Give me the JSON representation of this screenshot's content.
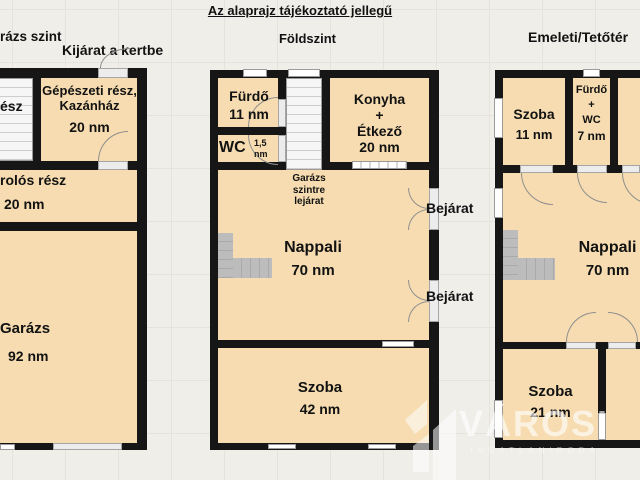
{
  "title": "Az alaprajz tájékoztató jellegű",
  "floors": {
    "garage_level": {
      "header": "rázs szint",
      "garden_exit_label": "Kijárat a kertbe",
      "stair_room_label": "ész",
      "mechanical_room": {
        "name": "Gépészeti rész, Kazánház",
        "area": "20 nm"
      },
      "storage_room": {
        "name": "rolós rész",
        "area": "20 nm"
      },
      "garage_room": {
        "name": "Garázs",
        "area": "92 nm"
      }
    },
    "ground_floor": {
      "header": "Földszint",
      "bathroom": {
        "name": "Fürdő",
        "area": "11 nm"
      },
      "wc": {
        "name": "WC",
        "area_value": "1,5",
        "area_unit": "nm"
      },
      "kitchen": {
        "line1": "Konyha",
        "line2": "+",
        "line3": "Étkező",
        "area": "20 nm"
      },
      "stair_note": "Garázs szintre lejárat",
      "living_room": {
        "name": "Nappali",
        "area": "70 nm"
      },
      "bedroom": {
        "name": "Szoba",
        "area": "42 nm"
      },
      "entrance_top": "Bejárat",
      "entrance_bottom": "Bejárat"
    },
    "upper_floor": {
      "header": "Emeleti/Tetőtér",
      "bedroom_small": {
        "name": "Szoba",
        "area": "11 nm"
      },
      "bathroom_wc": {
        "line1": "Fürdő",
        "line2": "+",
        "line3": "WC",
        "area": "7 nm"
      },
      "living_room": {
        "name": "Nappali",
        "area": "70 nm"
      },
      "bedroom": {
        "name": "Szoba",
        "area": "21 nm"
      }
    }
  },
  "watermark": {
    "brand": "VÁROSI",
    "subtitle": "INGATLANIRODA"
  },
  "colors": {
    "room_fill": "#f6dcb0",
    "wall": "#161616",
    "canvas_background": "#f0eee9",
    "stair_gray": "#b9b9b9",
    "watermark": "#ffffff"
  }
}
